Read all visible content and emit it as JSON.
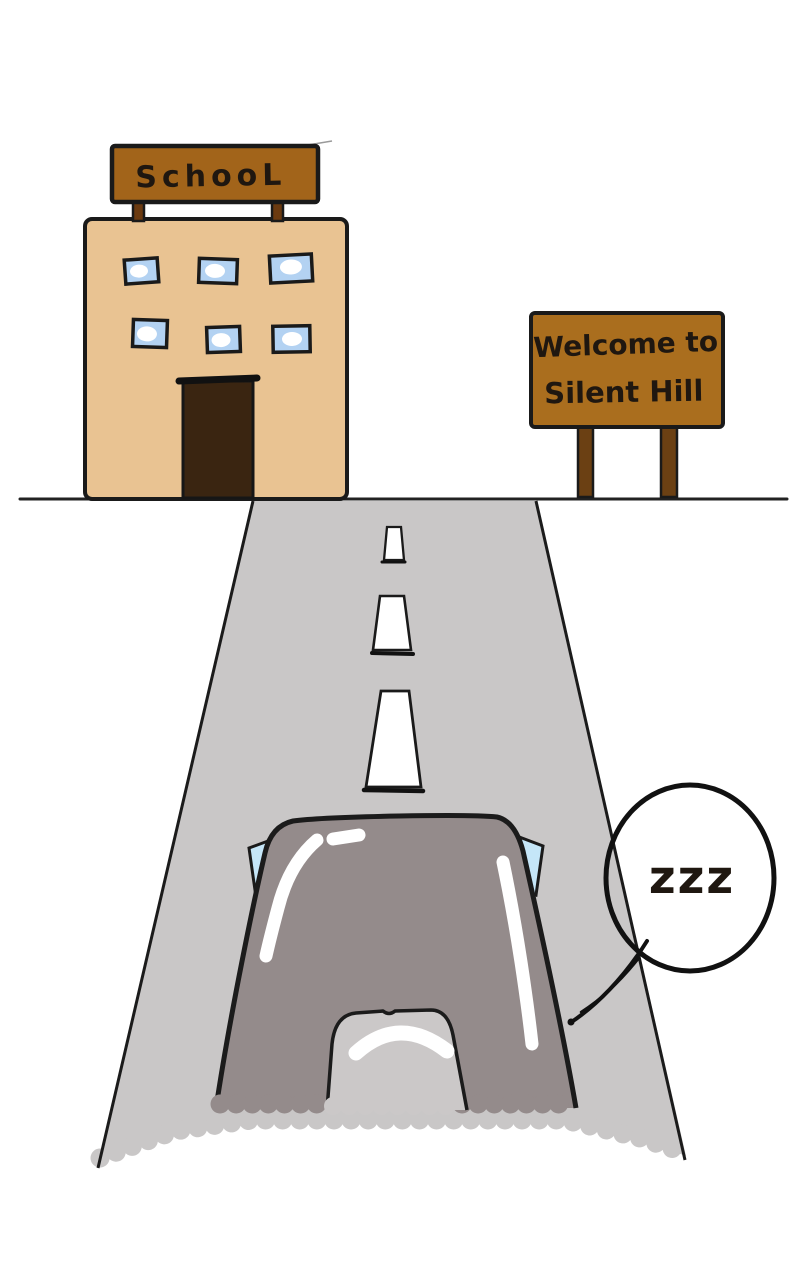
{
  "palette": {
    "outline": "#1a1a1a",
    "background": "#ffffff",
    "building": "#e9c392",
    "school_sign": "#a2641a",
    "school_posts": "#6b3a10",
    "door": "#3a2511",
    "window_blue": "#b3d2f2",
    "window_highlight": "#ffffff",
    "welcome_board": "#aa6e1e",
    "welcome_legs": "#6b4013",
    "road": "#c9c7c7",
    "dash_white": "#ffffff",
    "car_body": "#948b8b",
    "car_window": "#cbc8c8",
    "mirror_blue": "#c5e6f8",
    "highlight_white": "#ffffff",
    "bubble_stroke": "#111111",
    "text_dark": "#211810"
  },
  "school": {
    "sign_label": "SchooL",
    "window_count": 6
  },
  "welcome_sign": {
    "line1": "Welcome to",
    "line2": "Silent Hill"
  },
  "road": {
    "dash_count": 3
  },
  "speech_bubble": {
    "text": "zzz"
  }
}
